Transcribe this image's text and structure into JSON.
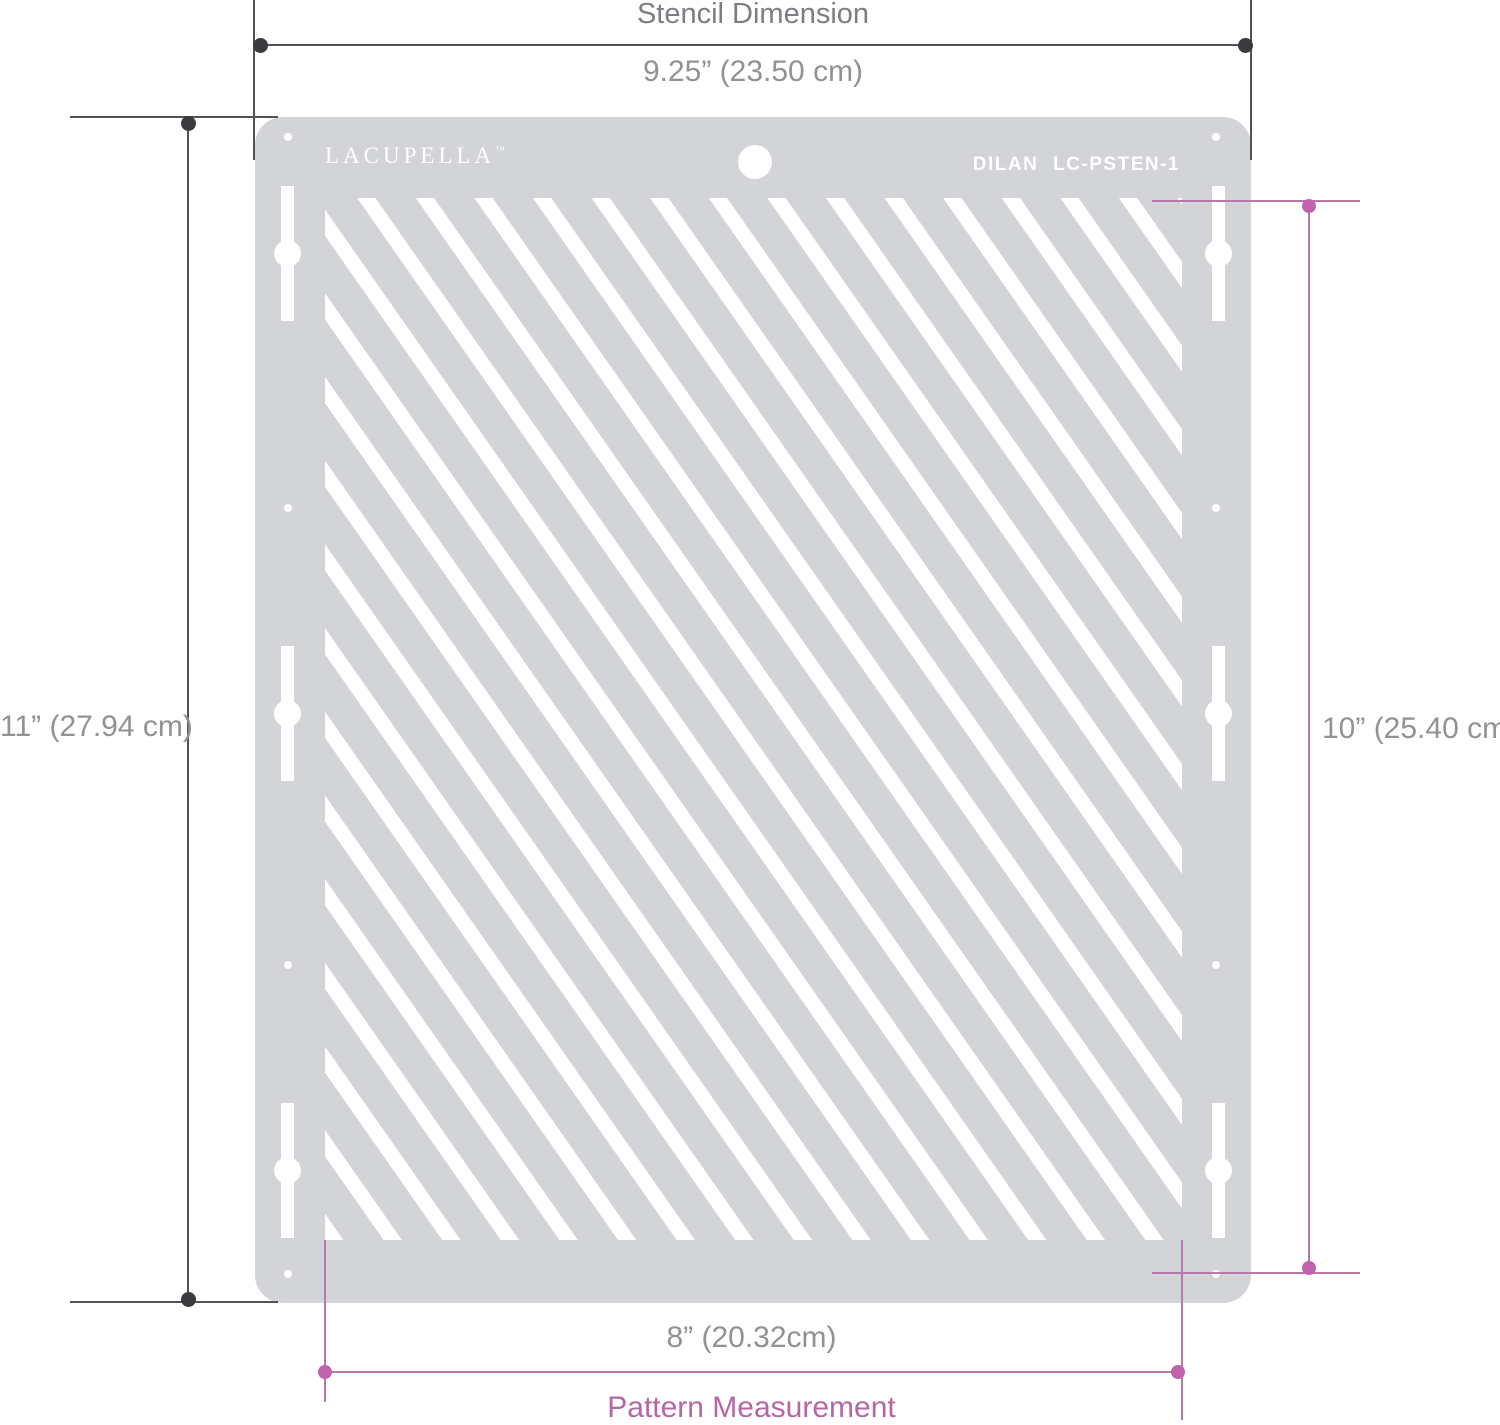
{
  "stencil": {
    "brand": "LACUPELLA",
    "brand_trademark": "™",
    "model_code": "DILAN LC-PSTEN-1",
    "pattern_description": "diagonal-stripes"
  },
  "annotations": {
    "stencil_dimension": {
      "title": "Stencil Dimension",
      "width_label": "9.25” (23.50 cm)",
      "height_label": "11” (27.94 cm)"
    },
    "pattern_measurement": {
      "title": "Pattern Measurement",
      "width_label": "8” (20.32cm)",
      "height_label": "10” (25.40 cm)"
    }
  },
  "colors": {
    "stencil": "#d2d4d7",
    "white": "#ffffff",
    "dark_line": "#515257",
    "dark_dot": "#3a3b3e",
    "pink_line": "#b778aa",
    "pink_dot": "#bf64ac",
    "pink_text": "#b466a6",
    "text_gray": "#909296",
    "title_gray": "#7c7e82"
  }
}
